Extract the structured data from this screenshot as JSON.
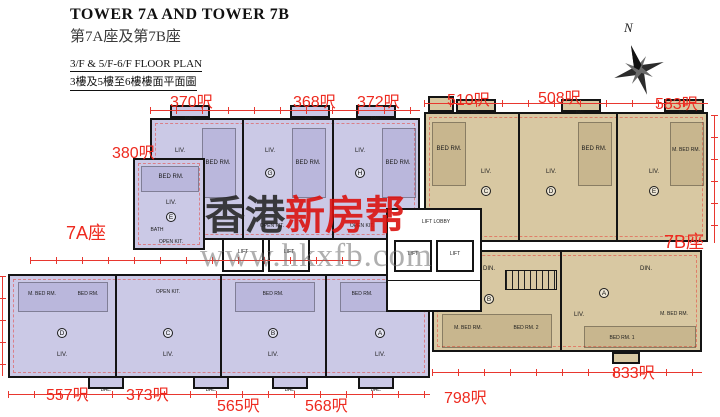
{
  "header": {
    "title_en": "TOWER 7A AND TOWER 7B",
    "title_zh": "第7A座及第7B座",
    "plan_title_en": "3/F & 5/F-6/F FLOOR PLAN",
    "plan_title_zh": "3樓及5樓至6樓樓面平面圖"
  },
  "compass": {
    "label": "N"
  },
  "watermark": {
    "brand_black": "香港",
    "brand_red": "新房帮",
    "url": "www.hkxfb.com"
  },
  "tower_labels": {
    "a": "7A座",
    "b": "7B座"
  },
  "area_labels": {
    "u380": "380呎",
    "u370": "370呎",
    "u368": "368呎",
    "u372": "372呎",
    "u510": "510呎",
    "u508": "508呎",
    "u583": "583呎",
    "u557": "557呎",
    "u373": "373呎",
    "u565": "565呎",
    "u568": "568呎",
    "u798": "798呎",
    "u833": "833呎"
  },
  "rooms": {
    "liv": "LIV.",
    "bed": "BED RM.",
    "mbed": "M. BED RM.",
    "bed1": "BED RM. 1",
    "bed2": "BED RM. 2",
    "din": "DIN.",
    "open_kit": "OPEN KIT.",
    "bath": "BATH",
    "bal": "BAL.",
    "lift": "LIFT",
    "lift_lobby": "LIFT LOBBY"
  },
  "units": {
    "a_upper": [
      "E",
      "F",
      "G",
      "H"
    ],
    "a_lower": [
      "D",
      "C",
      "B",
      "A"
    ],
    "b_upper": [
      "C",
      "D",
      "E"
    ],
    "b_lower": [
      "B",
      "A"
    ]
  },
  "colors": {
    "tower_a_fill": "#cbc9e6",
    "tower_b_fill": "#d8c8a2",
    "dimension_red": "#e8372f",
    "label_red": "#ee2a1f",
    "wall_black": "#141414"
  }
}
